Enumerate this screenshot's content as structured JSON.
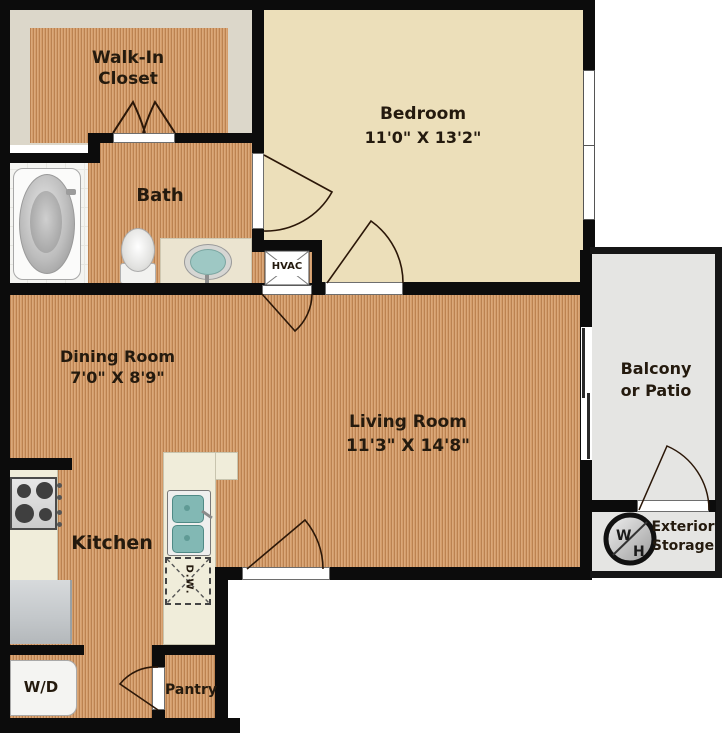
{
  "title": "One bedroom apartment floor plan",
  "rooms": {
    "walk_in_closet": {
      "line1": "Walk-In",
      "line2": "Closet"
    },
    "bedroom": {
      "label": "Bedroom",
      "dimensions": "11'0\" X 13'2\""
    },
    "bath": {
      "label": "Bath"
    },
    "hvac": {
      "label": "HVAC"
    },
    "dining_room": {
      "label": "Dining Room",
      "dimensions": "7'0\" X 8'9\""
    },
    "living_room": {
      "label": "Living Room",
      "dimensions": "11'3\" X 14'8\""
    },
    "balcony": {
      "line1": "Balcony",
      "line2": "or Patio"
    },
    "exterior_storage": {
      "line1": "Exterior",
      "line2": "Storage"
    },
    "water_heater": {
      "letter_w": "W",
      "letter_h": "H"
    },
    "kitchen": {
      "label": "Kitchen"
    },
    "washer_dryer": {
      "label": "W/D"
    },
    "pantry": {
      "label": "Pantry"
    },
    "dishwasher": {
      "label": "D.W."
    }
  },
  "colors": {
    "wood_floor": "#d49d6b",
    "bedroom_carpet": "#ecdfba",
    "closet_background": "#dcd7ca",
    "balcony_floor": "#e5e5e3",
    "counter": "#f0edda",
    "wall": "#0c0c0c",
    "label_text": "#241a0e",
    "sink_basin": "#82b8b4"
  }
}
